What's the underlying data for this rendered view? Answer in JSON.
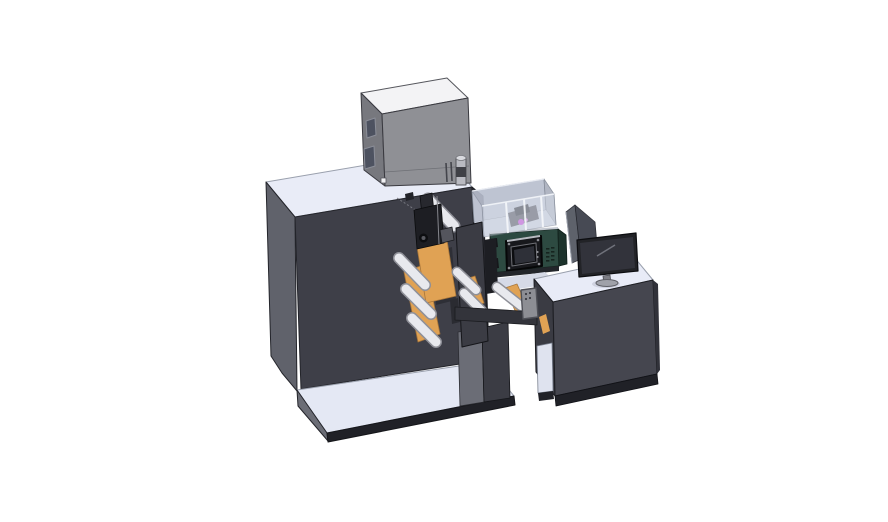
{
  "scene": {
    "type": "3d-cad-render",
    "subject": "Label printing press assembly: main cabinet with unwind rollers and print head, printer box on top, transparent guard enclosure, teal control panel with HMI screen, and operator desk with monitor and glass shield",
    "background": "#ffffff"
  },
  "colors": {
    "bg": "#ffffff",
    "edge": "#23242a",
    "edge_light": "#9aa0ad",
    "top_light": "#e9ecf7",
    "plate_top": "#e4e8f4",
    "cab_front": "#3e3f48",
    "cab_left": "#60626b",
    "cab_right": "#33343c",
    "box_top": "#f3f3f5",
    "box_front": "#8f9095",
    "box_left": "#77787e",
    "box_window": "#4d5260",
    "knob_body": "#b9bac1",
    "knob_top": "#d8d9de",
    "knob_band": "#3f4046",
    "roller_face": "#e8e9ee",
    "roller_edge": "#8f9098",
    "web_orange": "#e0a254",
    "head_dark": "#1d1e23",
    "head_up": "#27282e",
    "head_mid": "#54555d",
    "frame_plate": "#3b3c44",
    "subframe": "#2e2f36",
    "pedestal_left": "#6b6d76",
    "enc_wall": "#dfe5f0",
    "enc_left_wall": "#ccd2df",
    "enc_back": "#b8bece",
    "enc_right": "#a9afbd",
    "enc_floor": "#c9cedb",
    "enc_rib": "#f6f8fb",
    "interior_mech": "#5f616b",
    "interior_mech2": "#43454e",
    "magenta": "#c455d8",
    "magenta_hi": "#d88ae2",
    "green_face": "#2d4a41",
    "green_end": "#1d332c",
    "green_pad": "#16171b",
    "green_topline": "#c6cad2",
    "hmi_bezel": "#17181c",
    "hmi_silver": "#b9bbc2",
    "hmi_frame": "#0c0d10",
    "hmi_screen": "#2e3038",
    "vent": "#16241f",
    "shadow_strip": "#23262b",
    "deck": "#d6dae7",
    "gap_dark": "#1d1e23",
    "desk_top": "#e8ebf7",
    "desk_left": "#3a3b43",
    "desk_front": "#45464f",
    "desk_right": "#31323a",
    "base_dark": "#202127",
    "recess_light": "#dfe3ef",
    "beam": "#33343b",
    "remote_body": "#8d8e94",
    "remote_dot": "#3a3b41",
    "shield_a": "#565a64",
    "shield_b": "#3e414b",
    "mon_bezel": "#222327",
    "mon_screen": "#32333b",
    "mon_highlight": "#70727b",
    "mon_neck": "#7d7e85",
    "mon_base": "#9fa1a9",
    "mon_shadow": "#c4c8d6",
    "screw": "#8b8c92"
  },
  "components": [
    {
      "id": "machine-cabinet",
      "label": "Main press cabinet"
    },
    {
      "id": "base-plate",
      "label": "Machine base plate"
    },
    {
      "id": "printer-box",
      "label": "Printer unit on top"
    },
    {
      "id": "unwind-mechanism",
      "label": "Unwind rollers and media web"
    },
    {
      "id": "print-head",
      "label": "Print head assembly"
    },
    {
      "id": "side-frame-plate",
      "label": "Side frame plate"
    },
    {
      "id": "transparent-enclosure",
      "label": "Transparent guard enclosure"
    },
    {
      "id": "control-panel",
      "label": "Teal control panel with HMI screen"
    },
    {
      "id": "conveyor-beam",
      "label": "Web path beam"
    },
    {
      "id": "handheld-remote",
      "label": "Handheld pendant"
    },
    {
      "id": "pedestal",
      "label": "Support pedestal"
    },
    {
      "id": "operator-desk",
      "label": "Operator desk"
    },
    {
      "id": "glass-shield",
      "label": "Corner glass shield"
    },
    {
      "id": "desk-monitor",
      "label": "Desktop monitor"
    }
  ]
}
